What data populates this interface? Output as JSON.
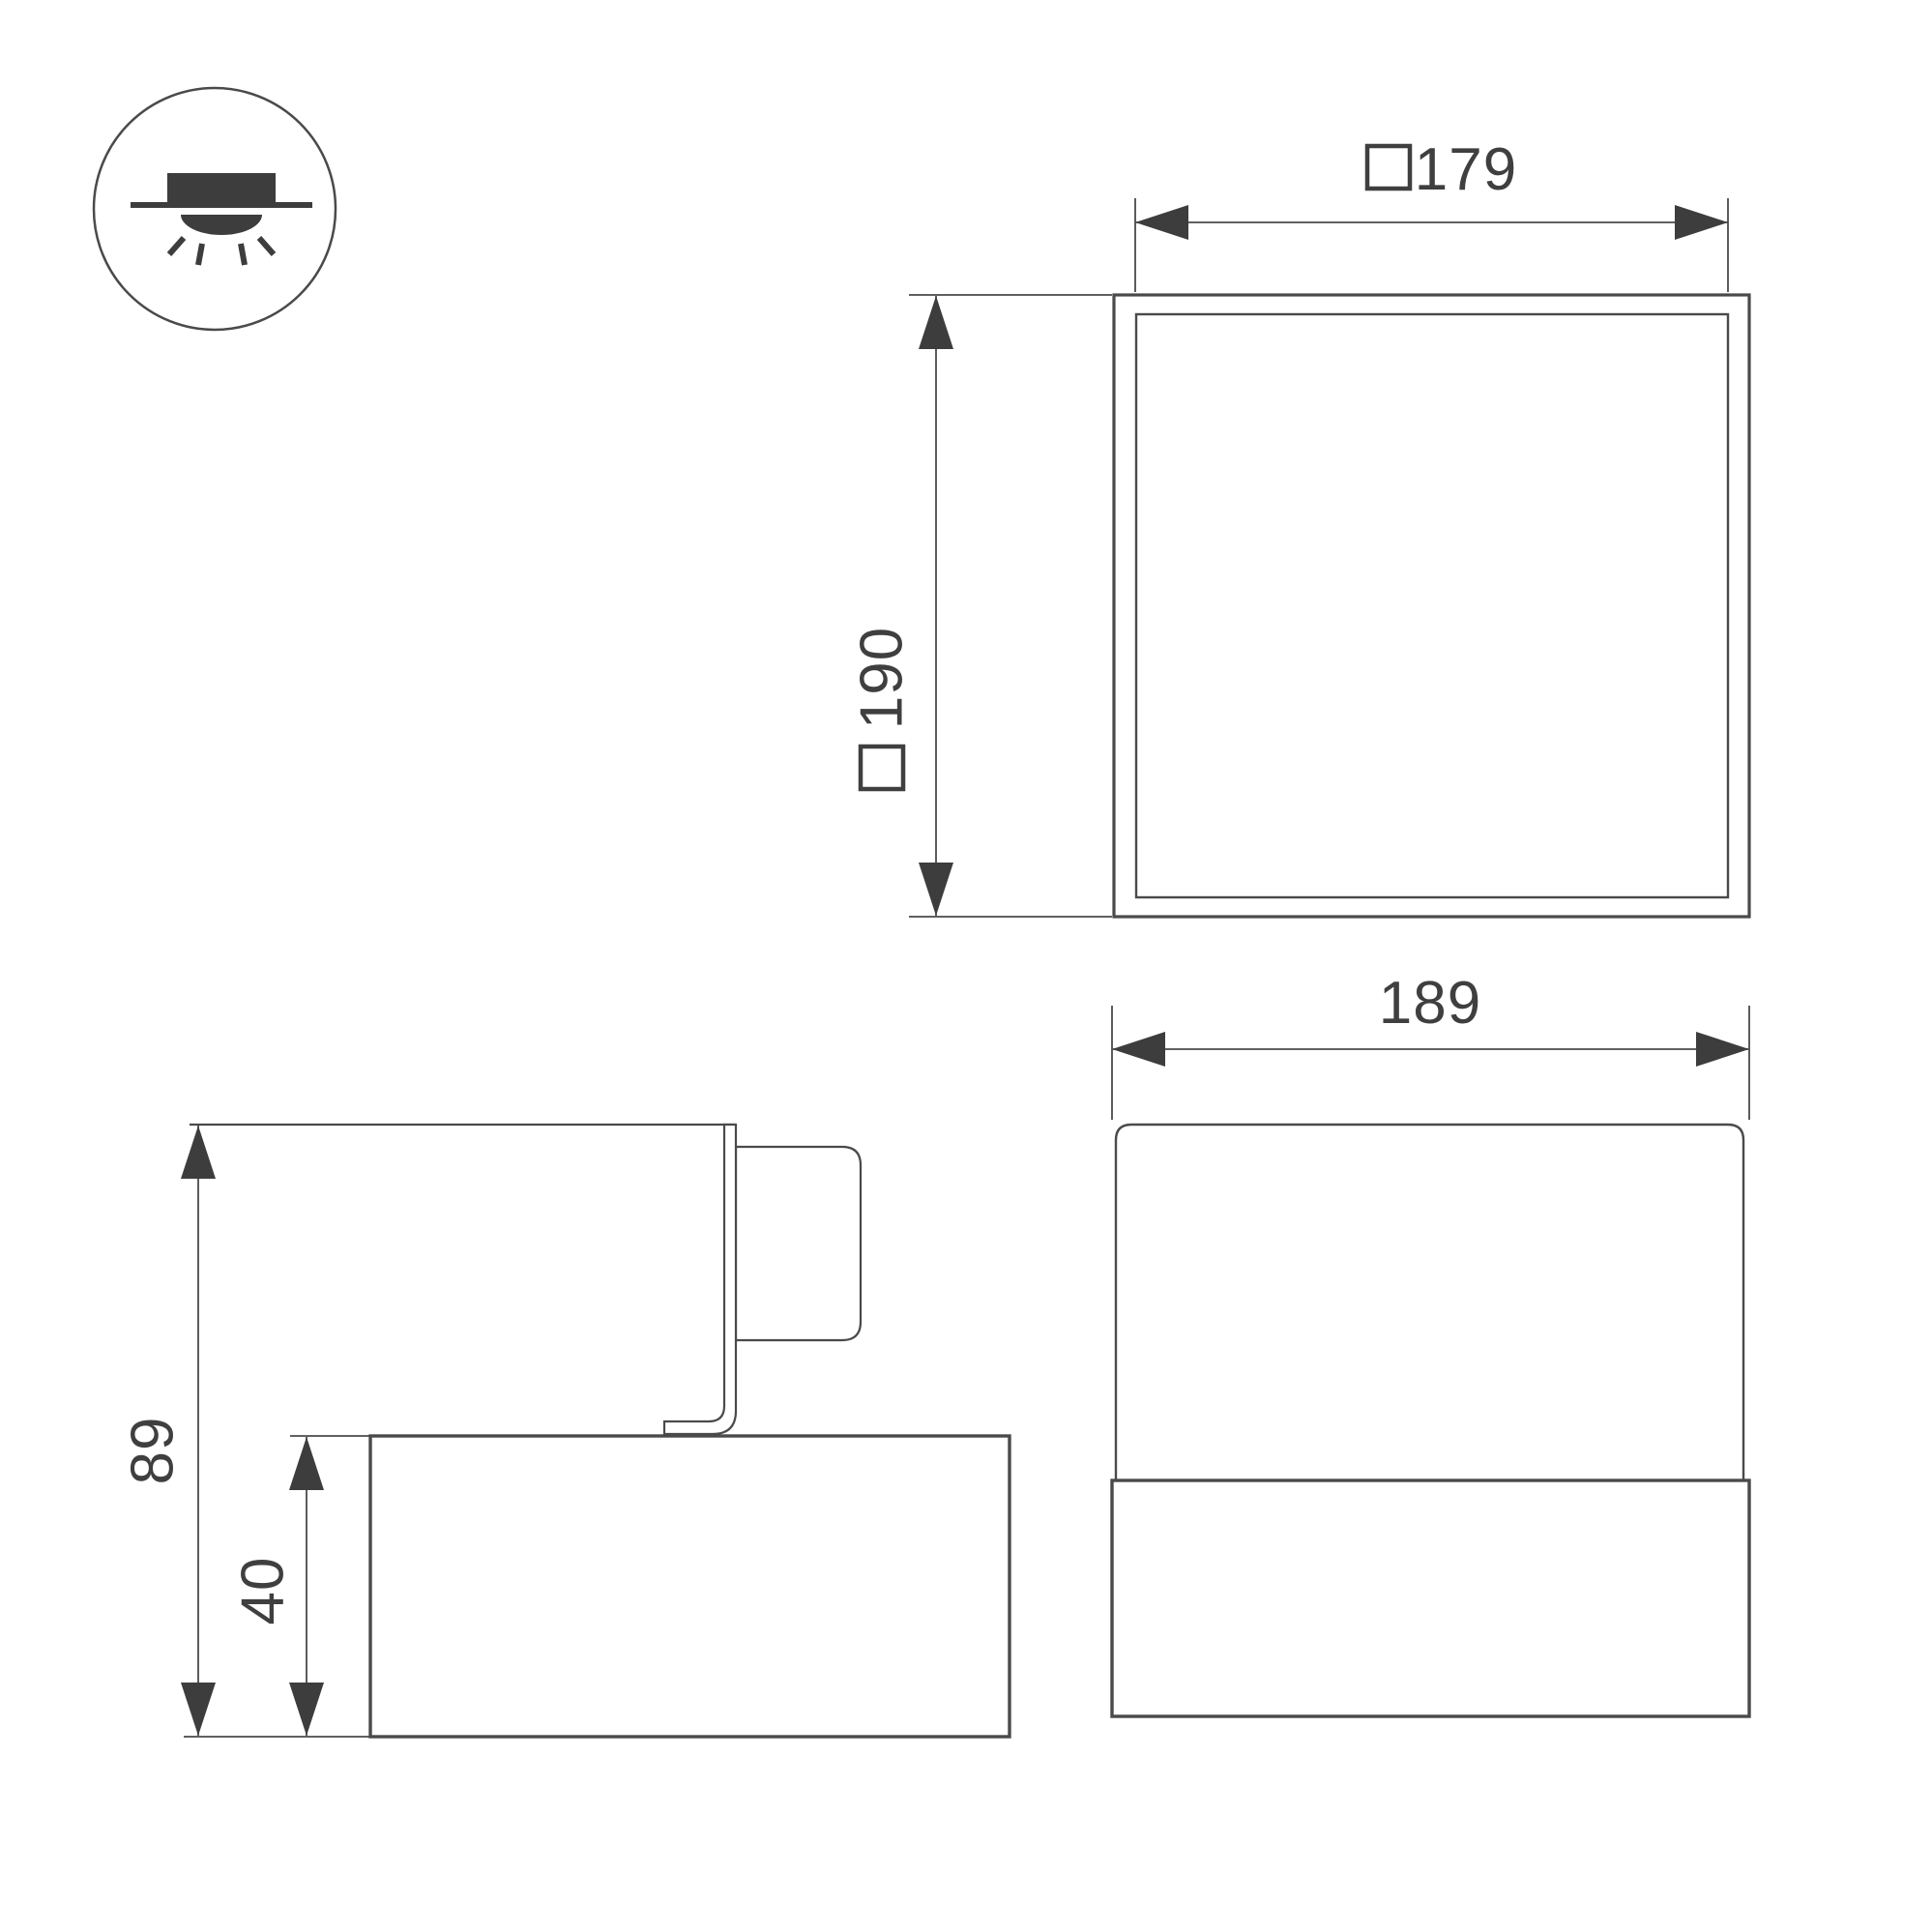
{
  "drawing": {
    "colors": {
      "line": "#4a4a4a",
      "dark_fill": "#3d3d3d",
      "background": "#ffffff"
    },
    "mount_icon": {
      "type": "surface-mounted-downlight"
    },
    "plan_view": {
      "inner_width": {
        "symbol": "square",
        "value": "179"
      },
      "outer_height": {
        "symbol": "square",
        "value": "190"
      }
    },
    "front_view": {
      "width": {
        "value": "189"
      }
    },
    "side_view": {
      "total_height": {
        "value": "89"
      },
      "base_height": {
        "value": "40"
      }
    }
  }
}
